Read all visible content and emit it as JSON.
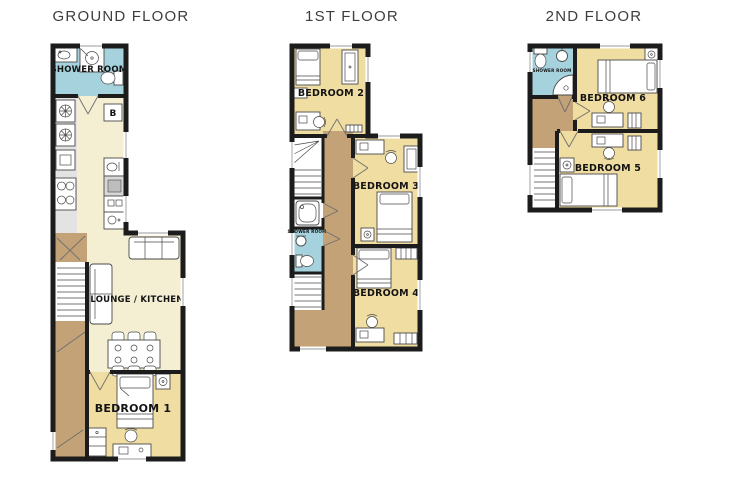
{
  "colors": {
    "wall": "#1c1c1c",
    "cream": "#f4eed3",
    "tan": "#f0dda1",
    "blue": "#a5d2dd",
    "brown": "#c2a276",
    "counter": "#e3e3e3",
    "line": "#4a4a4a",
    "title": "#3d3d3d",
    "label": "#141414"
  },
  "floors": [
    {
      "title": "GROUND FLOOR",
      "boiler": "B",
      "rooms": {
        "shower_room": "SHOWER ROOM",
        "lounge_kitchen": "LOUNGE / KITCHEN",
        "bedroom1": "BEDROOM 1"
      }
    },
    {
      "title": "1ST FLOOR",
      "rooms": {
        "bedroom2": "BEDROOM 2",
        "bedroom3": "BEDROOM 3",
        "bedroom4": "BEDROOM 4",
        "shower_room": "SHOWER ROOM"
      }
    },
    {
      "title": "2ND FLOOR",
      "rooms": {
        "shower_room": "SHOWER ROOM",
        "bedroom6": "BEDROOM 6",
        "bedroom5": "BEDROOM 5"
      }
    }
  ]
}
